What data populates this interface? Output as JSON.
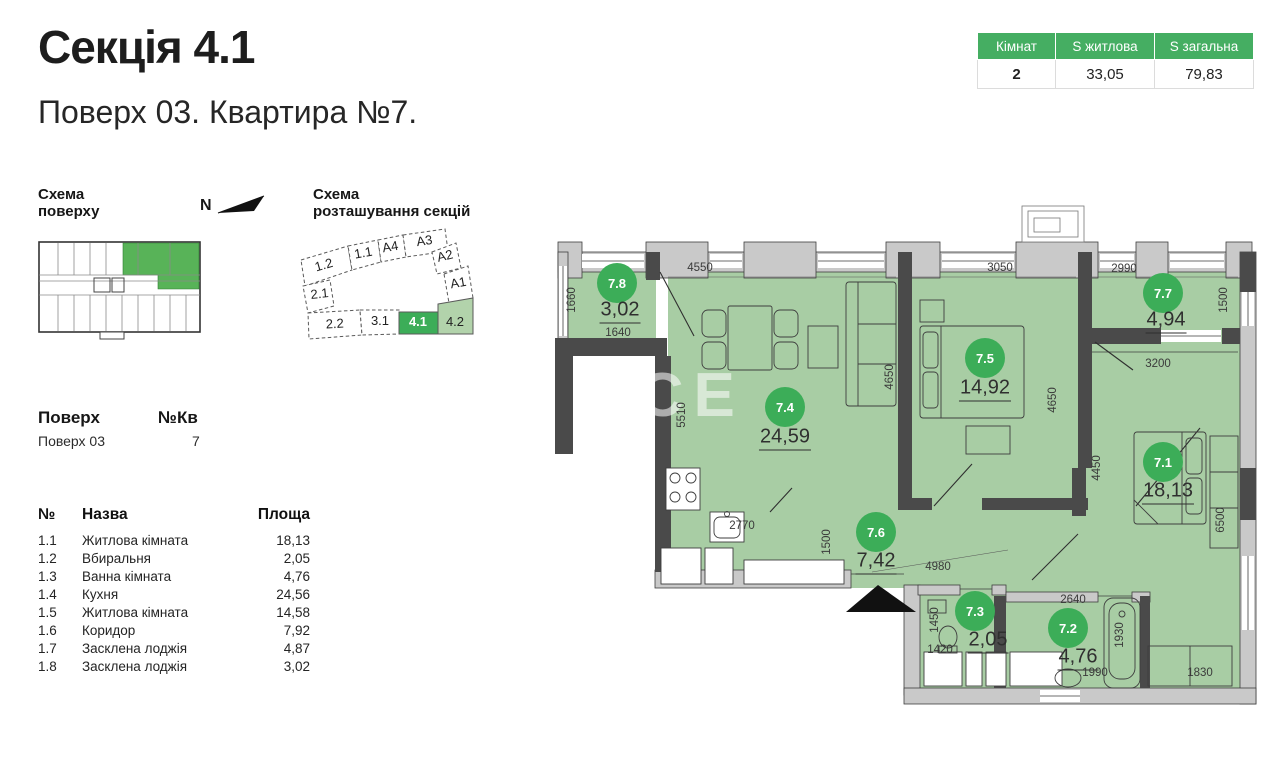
{
  "header": {
    "title": "Секція 4.1",
    "subtitle": "Поверх 03. Квартира №7."
  },
  "summary_table": {
    "col_rooms": "Кімнат",
    "col_living": "S житлова",
    "col_total": "S загальна",
    "rooms": "2",
    "living": "33,05",
    "total": "79,83"
  },
  "floor_scheme": {
    "label": "Схема\nповерху",
    "north": "N"
  },
  "section_scheme": {
    "label": "Схема\nрозташування секцій",
    "cells": [
      "1.2",
      "1.1",
      "A4",
      "A3",
      "A2",
      "A1",
      "2.1",
      "2.2",
      "3.1",
      "4.1",
      "4.2"
    ],
    "active": "4.1",
    "secondary": "4.2"
  },
  "floor_info": {
    "floor_label": "Поверх",
    "apt_label": "№Кв",
    "floor_value": "Поверх 03",
    "apt_value": "7"
  },
  "rooms_table": {
    "col_num": "№",
    "col_name": "Назва",
    "col_area": "Площа",
    "rows": [
      {
        "num": "1.1",
        "name": "Житлова кімната",
        "area": "18,13"
      },
      {
        "num": "1.2",
        "name": "Вбиральня",
        "area": "2,05"
      },
      {
        "num": "1.3",
        "name": "Ванна кімната",
        "area": "4,76"
      },
      {
        "num": "1.4",
        "name": "Кухня",
        "area": "24,56"
      },
      {
        "num": "1.5",
        "name": "Житлова кімната",
        "area": "14,58"
      },
      {
        "num": "1.6",
        "name": "Коридор",
        "area": "7,92"
      },
      {
        "num": "1.7",
        "name": "Засклена лоджія",
        "area": "4,87"
      },
      {
        "num": "1.8",
        "name": "Засклена лоджія",
        "area": "3,02"
      }
    ]
  },
  "plan": {
    "watermark": "NCE",
    "rooms": [
      {
        "id": "7.8",
        "area": "3,02"
      },
      {
        "id": "7.4",
        "area": "24,59"
      },
      {
        "id": "7.5",
        "area": "14,92"
      },
      {
        "id": "7.7",
        "area": "4,94"
      },
      {
        "id": "7.1",
        "area": "18,13"
      },
      {
        "id": "7.6",
        "area": "7,42"
      },
      {
        "id": "7.3",
        "area": "2,05"
      },
      {
        "id": "7.2",
        "area": "4,76"
      }
    ],
    "dimensions": [
      "4550",
      "3050",
      "2990",
      "1500",
      "1660",
      "1640",
      "5510",
      "4650",
      "4650",
      "3200",
      "4450",
      "6500",
      "2770",
      "1500",
      "4980",
      "1450",
      "1420",
      "2640",
      "1930",
      "1990",
      "1830"
    ]
  },
  "colors": {
    "accent_green": "#45ae62",
    "badge_green": "#3cad58",
    "room_fill": "#a8cda4",
    "light_green": "#b2d3ab"
  }
}
